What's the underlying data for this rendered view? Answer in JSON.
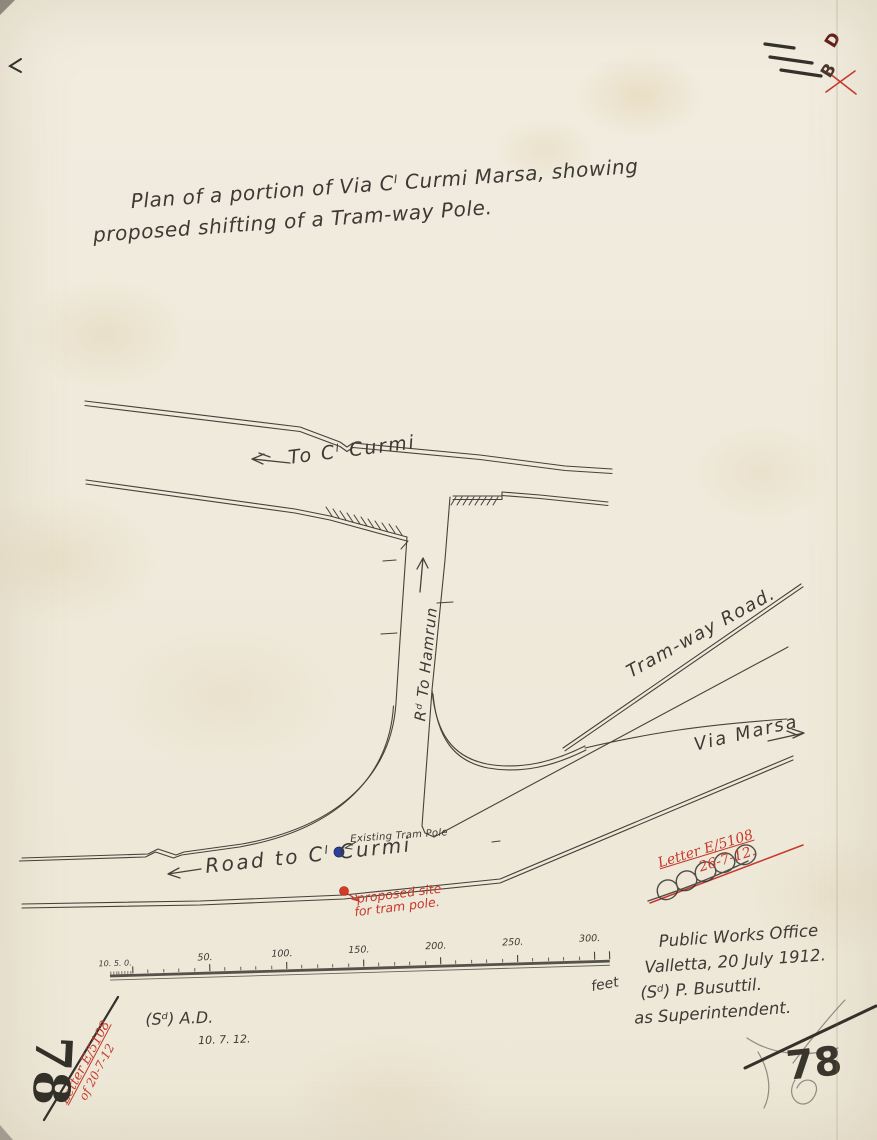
{
  "colors": {
    "paper": "#f0ebdf",
    "ink": "#3c3a34",
    "pencil": "#34312b",
    "red_ink": "#c6392b",
    "blue_marker": "#2b3f9e",
    "red_marker": "#d33a28"
  },
  "title": {
    "line1": "Plan of a portion of Via Cˡ Curmi Marsa, showing",
    "line2": "proposed shifting of a Tram-way Pole."
  },
  "map_labels": {
    "to_curmi": "To Cˡ Curmi",
    "rd_to_hamrun": "Rᵈ To Hamrun",
    "tramway_road": "Tram-way Road.",
    "via_marsa": "Via Marsa",
    "existing_tram_pole": "Existing Tram Pole",
    "road_to_curmi": "Road to Cˡ Curmi",
    "proposed_site_line1": "proposed site",
    "proposed_site_line2": "for tram pole."
  },
  "scale_bar": {
    "left_labels": "10. 5. 0.",
    "tick_labels": [
      "50.",
      "100.",
      "150.",
      "200.",
      "250.",
      "300."
    ],
    "unit": "feet"
  },
  "signature_block": {
    "line1": "Public Works Office",
    "line2": "Valletta, 20 July 1912.",
    "line3": "(Sᵈ) P. Busuttil.",
    "line4": "as Superintendent."
  },
  "approval_note": {
    "initials": "(Sᵈ) A.D.",
    "date": "10. 7. 12."
  },
  "file_refs": {
    "left_line1": "Letter E/5108",
    "left_line2": "of 20-7-12",
    "right_line1": "Letter E/5108",
    "right_line2": "26-7-12."
  },
  "page_numbers": {
    "bottom_left": "78",
    "bottom_right": "78"
  },
  "stamps": {
    "letter_d": "D",
    "letter_b": "B"
  }
}
